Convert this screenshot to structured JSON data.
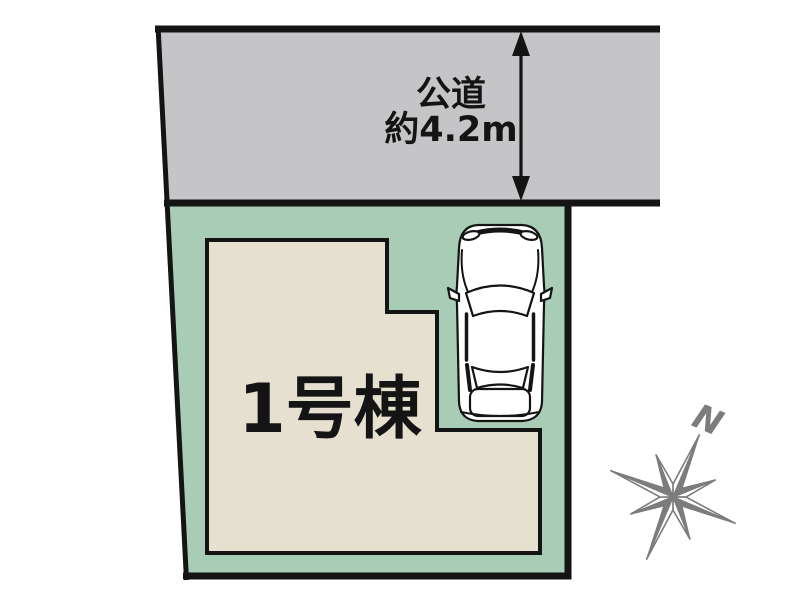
{
  "road": {
    "name": "公道",
    "width": "約4.2m"
  },
  "building": {
    "label": "1号棟"
  },
  "compass": {
    "north": "N"
  },
  "colors": {
    "road_fill": "#c5c5c7",
    "plot_fill": "#a8ccb6",
    "building_fill": "#e6e0d1",
    "line": "#141414",
    "compass": "#7c7c7e"
  }
}
